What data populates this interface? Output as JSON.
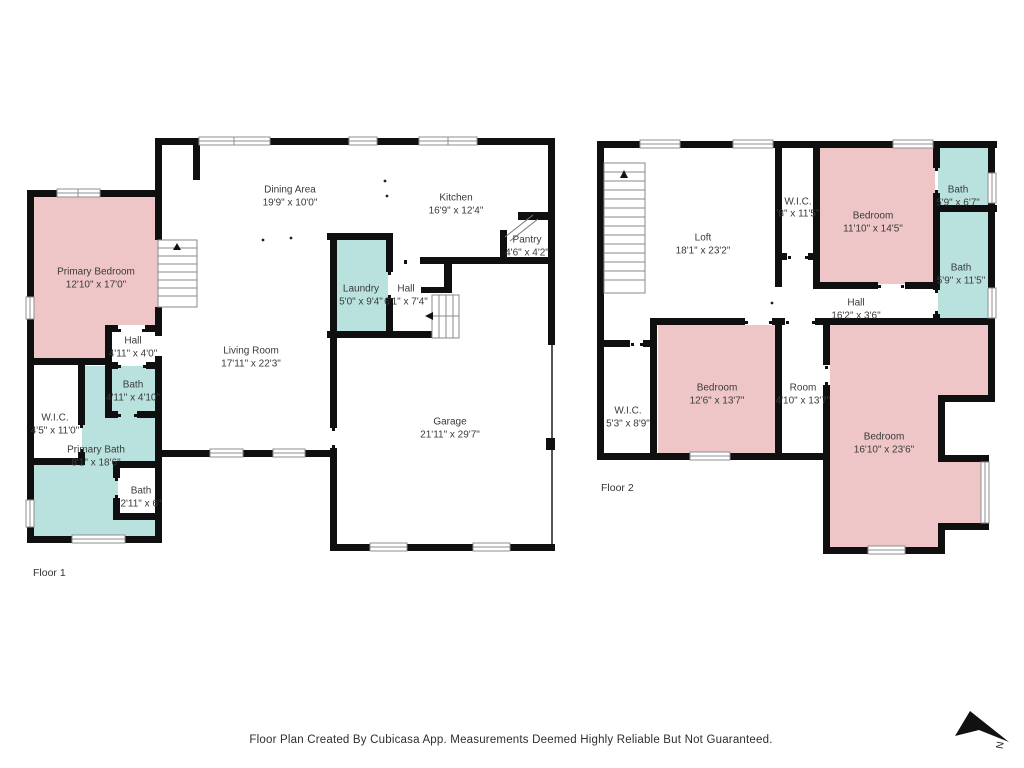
{
  "palette": {
    "wall": "#0f0f0f",
    "pink": "#efc6c7",
    "teal": "#b9e2df",
    "label_text": "#3a3a3a"
  },
  "floor1": {
    "caption": "Floor 1",
    "rooms": [
      {
        "name": "Primary Bedroom",
        "dims": "12'10\" x 17'0\""
      },
      {
        "name": "Dining Area",
        "dims": "19'9\" x 10'0\""
      },
      {
        "name": "Kitchen",
        "dims": "16'9\" x 12'4\""
      },
      {
        "name": "Pantry",
        "dims": "4'6\" x 4'2\""
      },
      {
        "name": "Laundry",
        "dims": "5'0\" x 9'4\""
      },
      {
        "name": "Hall",
        "dims": "6'1\" x 7'4\""
      },
      {
        "name": "Hall",
        "dims": "4'11\" x 4'0\""
      },
      {
        "name": "Living Room",
        "dims": "17'11\" x 22'3\""
      },
      {
        "name": "Bath",
        "dims": "4'11\" x 4'10\""
      },
      {
        "name": "W.I.C.",
        "dims": "4'5\" x 11'0\""
      },
      {
        "name": "Primary Bath",
        "dims": "8'1\" x 18'6\""
      },
      {
        "name": "Bath",
        "dims": "2'11\" x 6\""
      },
      {
        "name": "Garage",
        "dims": "21'11\" x 29'7\""
      }
    ]
  },
  "floor2": {
    "caption": "Floor 2",
    "rooms": [
      {
        "name": "Loft",
        "dims": "18'1\" x 23'2\""
      },
      {
        "name": "W.I.C.",
        "dims": "'8\" x 11'5\""
      },
      {
        "name": "Bedroom",
        "dims": "11'10\" x 14'5\""
      },
      {
        "name": "Bath",
        "dims": "5'9\" x 6'7\""
      },
      {
        "name": "Bath",
        "dims": "5'9\" x 11'5\""
      },
      {
        "name": "Hall",
        "dims": "16'2\" x 3'6\""
      },
      {
        "name": "Bedroom",
        "dims": "12'6\" x 13'7\""
      },
      {
        "name": "Room",
        "dims": "4'10\" x 13'7\""
      },
      {
        "name": "W.I.C.",
        "dims": "5'3\" x 8'9\""
      },
      {
        "name": "Bedroom",
        "dims": "16'10\" x 23'6\""
      }
    ]
  },
  "footer": {
    "text": "Floor Plan Created By Cubicasa App. Measurements Deemed Highly Reliable But Not Guaranteed."
  },
  "compass": {
    "label": "N"
  }
}
